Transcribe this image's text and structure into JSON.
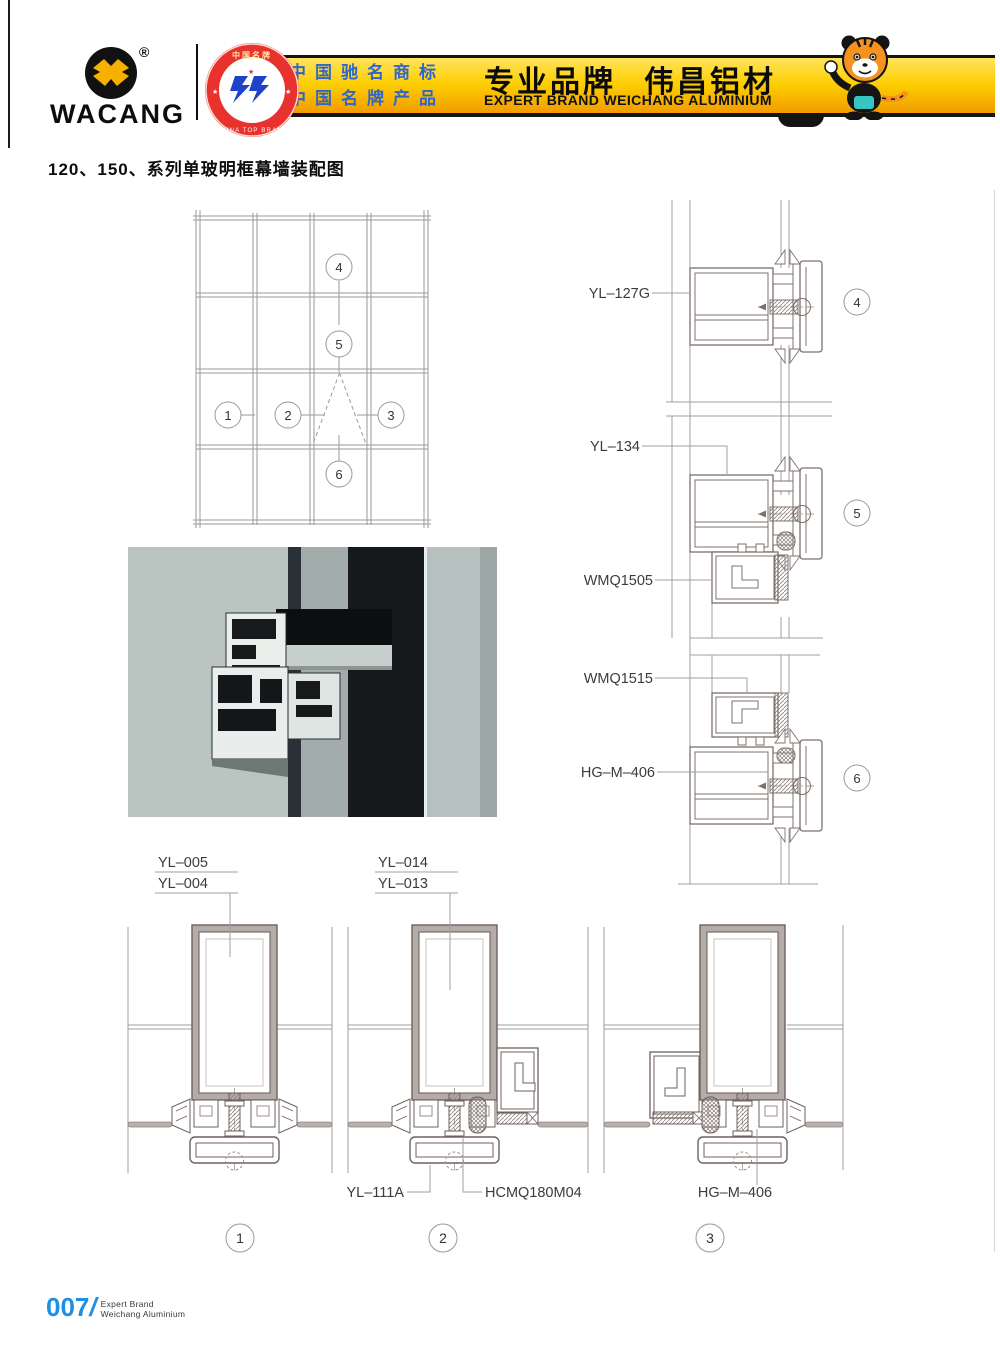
{
  "header": {
    "logo": {
      "brand": "WACANG",
      "registered": "®"
    },
    "badge": {
      "top": "中国名牌",
      "bottom": "CHINA TOP BRAND",
      "star_left": "★",
      "star_right": "★"
    },
    "banner": {
      "credential_line1": "中国驰名商标",
      "credential_line2": "中国名牌产品",
      "slogan_cn": "专业品牌",
      "brand_cn": "伟昌铝材",
      "subtitle_en": "EXPERT BRAND WEICHANG ALUMINIUM"
    }
  },
  "page_title": "120、150、系列单玻明框幕墙装配图",
  "elevation": {
    "callouts": [
      "1",
      "2",
      "3",
      "4",
      "5",
      "6"
    ]
  },
  "right_details": {
    "label_yl127g": "YL–127G",
    "label_yl134": "YL–134",
    "label_wmq1505": "WMQ1505",
    "label_wmq1515": "WMQ1515",
    "label_hgm406": "HG–M–406",
    "callout_4": "4",
    "callout_5": "5",
    "callout_6": "6"
  },
  "bottom_details": {
    "stack_left": [
      "YL–005",
      "YL–004"
    ],
    "stack_mid": [
      "YL–014",
      "YL–013"
    ],
    "label_yl111a": "YL–111A",
    "label_hcmq180m04": "HCMQ180M04",
    "label_hgm406": "HG–M–406",
    "callout_1": "1",
    "callout_2": "2",
    "callout_3": "3"
  },
  "footer": {
    "page_number": "007",
    "divider": "/",
    "tagline_line1": "Expert Brand",
    "tagline_line2": "Weichang Aluminium"
  },
  "colors": {
    "banner_gold": "#fdce00",
    "credential_blue": "#2f66cc",
    "page_number_blue": "#1e8fe6",
    "photo_background": "#b3beba"
  }
}
